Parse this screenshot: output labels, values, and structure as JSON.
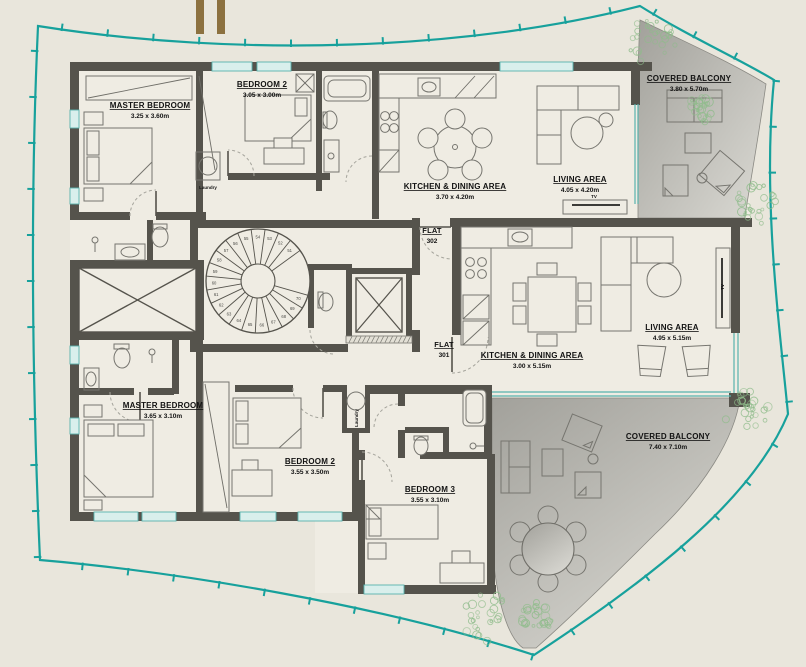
{
  "title": "Residential floor plan — flats 301 and 302",
  "palette": {
    "background": "#e9e6dc",
    "plot_line": "#17a19c",
    "wall": "#55534c",
    "glass": "#58b2ad",
    "balcony_dark": "#a5a49e",
    "balcony_light": "#dbdad4",
    "furniture_line": "#76756f",
    "plant_green": "#8fbc8b",
    "gold_bar": "#8c7140",
    "text": "#121212"
  },
  "rooms": [
    {
      "id": "master-bedroom-302",
      "name": "MASTER BEDROOM",
      "dims": "3.25 x 3.60m"
    },
    {
      "id": "bedroom2-302",
      "name": "BEDROOM 2",
      "dims": "3.05 x 3.00m"
    },
    {
      "id": "kitchen-dining-302",
      "name": "KITCHEN & DINING AREA",
      "dims": "3.70 x 4.20m"
    },
    {
      "id": "living-302",
      "name": "LIVING AREA",
      "dims": "4.05 x 4.20m"
    },
    {
      "id": "covered-balcony-302",
      "name": "COVERED BALCONY",
      "dims": "3.80 x 5.70m"
    },
    {
      "id": "master-bedroom-301",
      "name": "MASTER BEDROOM",
      "dims": "3.65 x 3.10m"
    },
    {
      "id": "bedroom2-301",
      "name": "BEDROOM 2",
      "dims": "3.55 x 3.50m"
    },
    {
      "id": "bedroom3-301",
      "name": "BEDROOM 3",
      "dims": "3.55 x 3.10m"
    },
    {
      "id": "kitchen-dining-301",
      "name": "KITCHEN & DINING AREA",
      "dims": "3.00 x 5.15m"
    },
    {
      "id": "living-301",
      "name": "LIVING AREA",
      "dims": "4.95 x 5.15m"
    },
    {
      "id": "covered-balcony-301",
      "name": "COVERED BALCONY",
      "dims": "7.40 x 7.10m"
    }
  ],
  "flat_tags": [
    {
      "label": "FLAT",
      "number": "302"
    },
    {
      "label": "FLAT",
      "number": "301"
    }
  ],
  "small_labels": {
    "laundry": "Laundry",
    "tv": "TV"
  },
  "stairs": {
    "steps": [
      "51",
      "52",
      "53",
      "54",
      "55",
      "56",
      "57",
      "58",
      "59",
      "60",
      "61",
      "62",
      "63",
      "64",
      "65",
      "66",
      "67",
      "68",
      "69",
      "70"
    ]
  }
}
